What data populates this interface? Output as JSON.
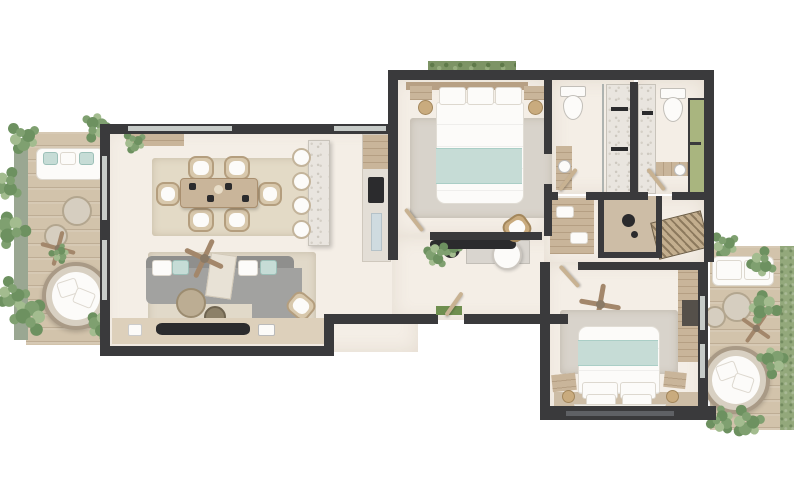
{
  "scene": {
    "type": "apartment-floor-plan-render",
    "view": "top-down",
    "rooms": [
      {
        "name": "left-terrace",
        "furniture": [
          "planters",
          "outdoor-sofa",
          "poufs",
          "ceiling-fan",
          "round-daybed",
          "wood-deck"
        ]
      },
      {
        "name": "living-dining-kitchen",
        "furniture": [
          "console",
          "dining-table",
          "six-dining-chairs",
          "kitchen-island",
          "four-bar-stools",
          "tall-kitchen-cabinet",
          "corner-sofa",
          "coffee-tables",
          "ceiling-fan",
          "sideboard-counter",
          "armchair",
          "area-rugs"
        ]
      },
      {
        "name": "hallway",
        "furniture": [
          "entry-door",
          "doormat",
          "bench",
          "potted-plant",
          "round-chair"
        ]
      },
      {
        "name": "bedroom-1",
        "furniture": [
          "double-bed",
          "nightstands",
          "pendant-lamps",
          "area-rug",
          "desk",
          "rattan-chair",
          "potted-plant",
          "planter-window"
        ]
      },
      {
        "name": "bathroom-1",
        "furniture": [
          "toilet",
          "walk-in-shower",
          "vanity"
        ]
      },
      {
        "name": "bathroom-2",
        "furniture": [
          "toilet",
          "shower",
          "vanity",
          "green-window"
        ]
      },
      {
        "name": "dressing-area",
        "furniture": [
          "wardrobe-bench",
          "walk-in-shower",
          "louvered-wardrobe"
        ]
      },
      {
        "name": "bedroom-2",
        "furniture": [
          "double-bed",
          "bedside-lamps",
          "benches",
          "area-rug",
          "ceiling-fan",
          "wardrobe",
          "window-wall",
          "wood-platform"
        ]
      },
      {
        "name": "right-terrace",
        "furniture": [
          "outdoor-sofa",
          "poufs",
          "ceiling-fan",
          "round-daybed",
          "planting",
          "lawn-strip"
        ]
      }
    ]
  },
  "palette": {
    "bg": "#ffffff",
    "wall": "#3a3a3c",
    "dark": "#2b2b2d",
    "floor": "#f4eee6",
    "deck": "#d2c3ab",
    "wood": "#c9b59a",
    "marble": "#e9e5df",
    "rug": "#e3dac6",
    "ruggray": "#d8d3cb",
    "sofagray": "#a2a2a0",
    "sofaback": "#8f8f8d",
    "teal": "#c6dcd6",
    "whitef": "#fcfbf9",
    "plantdark": "#6d9160",
    "plantmid": "#7fa070",
    "plantlight": "#a3bc8f",
    "grass": "#93a87b",
    "glass": "#c6cbc8",
    "glassdark": "#5f6165",
    "windowgreen": "#a9b57f",
    "rattan": "#c9ab7e",
    "matgreen": "#6f8f4f",
    "door": "#c8b292",
    "fanc": "#a3876b"
  }
}
